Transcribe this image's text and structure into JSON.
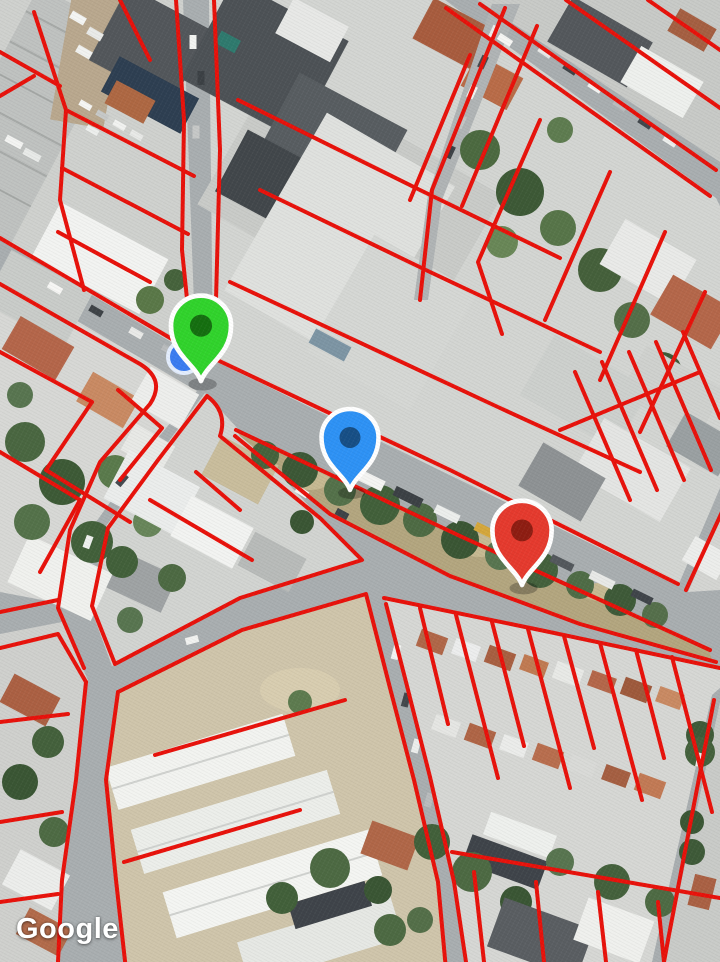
{
  "attribution": {
    "logo_text": "Google"
  },
  "map": {
    "view": "satellite",
    "overlay": {
      "color": "#e8120b",
      "stroke_width": 4,
      "description": "red parcel boundary overlay"
    },
    "markers": [
      {
        "type": "dot",
        "name": "location-dot",
        "x": 184,
        "y": 357,
        "radius": 16,
        "color": "#3b7cf0",
        "ring_color": "#e3edfd"
      },
      {
        "type": "pin",
        "name": "green-pin",
        "x": 201,
        "y": 381,
        "scale": 1.58,
        "color": "#31d32c",
        "inner_color": "#156f10",
        "outline_color": "#ffffff"
      },
      {
        "type": "pin",
        "name": "blue-pin",
        "x": 350,
        "y": 490,
        "scale": 1.5,
        "color": "#2e92f5",
        "inner_color": "#174f86",
        "outline_color": "#ffffff"
      },
      {
        "type": "pin",
        "name": "red-pin",
        "x": 522,
        "y": 585,
        "scale": 1.56,
        "color": "#e53a2e",
        "inner_color": "#8e1d12",
        "outline_color": "#ffffff"
      }
    ]
  }
}
